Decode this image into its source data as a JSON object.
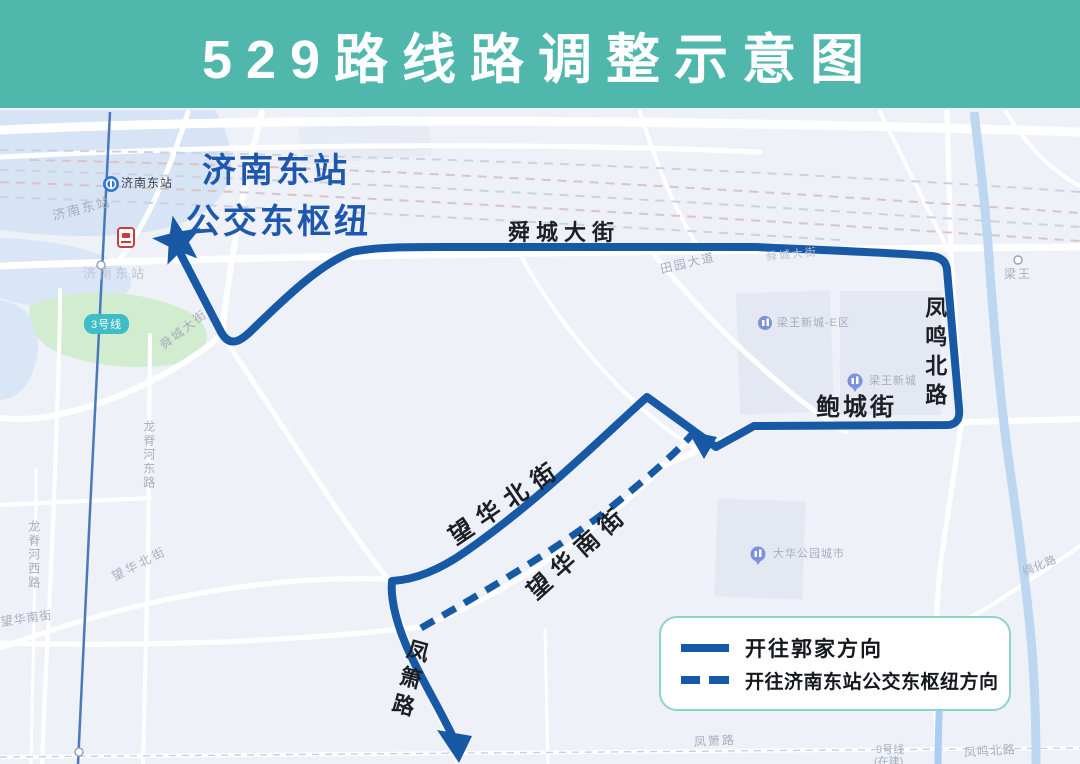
{
  "title": "529路线路调整示意图",
  "hub": {
    "line1": "济南东站",
    "line2": "公交东枢纽"
  },
  "legend": {
    "solid_label": "开往郭家方向",
    "dashed_label": "开往济南东站公交东枢纽方向"
  },
  "route_streets": {
    "shuncheng": "舜城大街",
    "fengming_north": "凤鸣北路",
    "baocheng": "鲍城街",
    "wanghua_north": "望华北街",
    "wanghua_south": "望华南街",
    "fengxiao": "凤箫路"
  },
  "map_labels": {
    "metro_station": "济南东站",
    "rail_station_upper": "济南东站",
    "rail_station_lower": "济南东站",
    "line3_badge": "3号线",
    "shuncheng_sw": "舜城大街",
    "shuncheng_faint": "舜城大街",
    "tianyuan": "田园大道",
    "liangwang": "梁王",
    "liangwang_e_district": "梁王新城-E区",
    "liangwang_xincheng": "梁王新城",
    "dahua_park_city": "大华公园城市",
    "longji_east": "龙脊河东路",
    "longji_west": "龙脊河西路",
    "wanghua_north_gray": "望华北街",
    "wanghua_south_gray": "望华南街",
    "chouhua": "绸化路",
    "fengxiao_gray": "凤箫路",
    "line9": "9号线",
    "line9_status": "(在建)",
    "fengming_gray": "凤鸣北路"
  },
  "colors": {
    "header_bg": "#4fb7ac",
    "route": "#1859a6",
    "station_text": "#1d57ae",
    "badge": "#3fbdc7"
  }
}
